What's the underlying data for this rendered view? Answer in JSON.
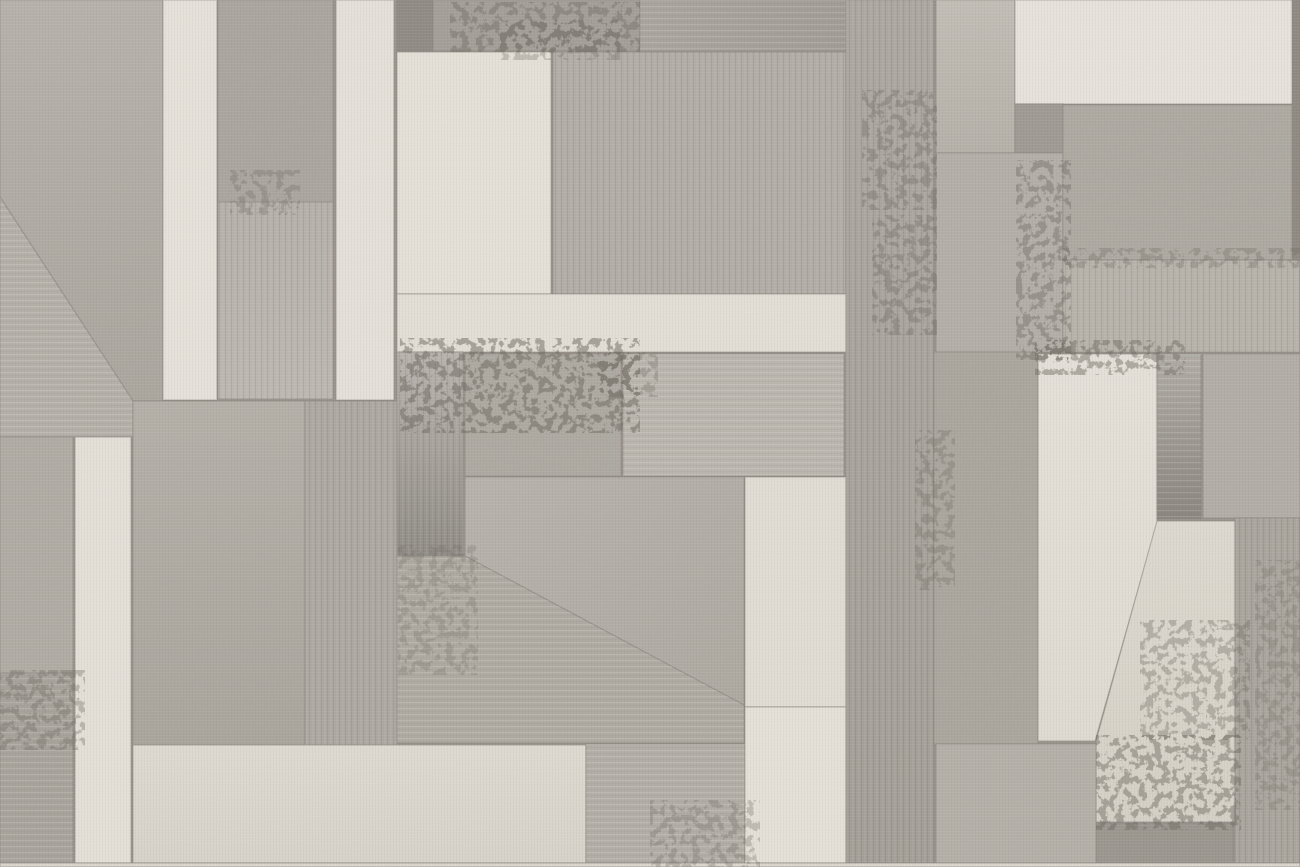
{
  "artwork": {
    "type": "abstract-geometric-patchwork-wallpaper",
    "description": "Abstract patchwork of rectangular and trapezoidal panels in warm grays and creams with concrete and linen grunge textures; thin dark seams between panels; two large diagonal cuts (upper left block and center block) and a slanted cream pentagon on the right.",
    "canvas": {
      "width": 1300,
      "height": 867
    },
    "seam_color": "#8b867f",
    "stain_color": "#6c675f",
    "palette": {
      "cream_light": "#e9e4dc",
      "cream": "#e7e2d9",
      "cream_dark": "#ddd8cf",
      "gray_light": "#c0bbb3",
      "gray_mid": "#b2ada6",
      "gray_deep": "#a9a49c",
      "gray_dark": "#8f8a83"
    },
    "tiles": [
      {
        "name": "big-gray-top-left",
        "poly": "0,0 163,0 163,401 133,401 0,197",
        "grad": {
          "from": "#b7b2ab",
          "to": "#aba69e",
          "dir": "v"
        }
      },
      {
        "name": "diagonal-lower-piece",
        "poly": "0,197 133,401 133,437 0,437",
        "fill": "#b6b1a9",
        "overlay": "h"
      },
      {
        "name": "left-mid-block",
        "rect": [
          0,
          437,
          73,
          236
        ],
        "fill": "#b1aca4"
      },
      {
        "name": "left-lower-block",
        "rect": [
          0,
          673,
          73,
          190
        ],
        "fill": "#a9a49c",
        "overlay": "h"
      },
      {
        "name": "left-cream-strip",
        "rect": [
          75,
          437,
          56,
          426
        ],
        "fill": "#e6e1d9"
      },
      {
        "name": "cream-strip-1",
        "rect": [
          163,
          0,
          54,
          400
        ],
        "fill": "#e8e3db"
      },
      {
        "name": "column2-upper",
        "rect": [
          218,
          0,
          115,
          202
        ],
        "fill": "#aba69f"
      },
      {
        "name": "column2-lower",
        "rect": [
          218,
          202,
          115,
          197
        ],
        "grad": {
          "from": "#b4afa8",
          "to": "#bcb7b0",
          "dir": "v"
        },
        "overlay": "v"
      },
      {
        "name": "cream-strip-2",
        "rect": [
          336,
          0,
          58,
          400
        ],
        "fill": "#e7e2da"
      },
      {
        "name": "dark-grunge-square",
        "rect": [
          397,
          0,
          36,
          53
        ],
        "fill": "#908b84"
      },
      {
        "name": "top-band-left",
        "rect": [
          433,
          0,
          207,
          51
        ],
        "fill": "#a49f98"
      },
      {
        "name": "top-band-right",
        "rect": [
          640,
          0,
          208,
          51
        ],
        "grad": {
          "from": "#aba69f",
          "to": "#a29d96",
          "dir": "h"
        },
        "overlay": "h"
      },
      {
        "name": "cream-block-upper-mid",
        "rect": [
          397,
          52,
          154,
          242
        ],
        "fill": "#e7e2d9"
      },
      {
        "name": "gray-block-upper-mid",
        "rect": [
          553,
          52,
          293,
          242
        ],
        "fill": "#b1aca5",
        "overlay": "v"
      },
      {
        "name": "cream-bar",
        "rect": [
          397,
          294,
          449,
          58
        ],
        "fill": "#e5e0d7"
      },
      {
        "name": "grunge-block-left",
        "rect": [
          133,
          401,
          172,
          344
        ],
        "grad": {
          "from": "#b5b0a8",
          "to": "#aaa59d",
          "dir": "v"
        }
      },
      {
        "name": "grunge-block-right",
        "rect": [
          305,
          401,
          92,
          344
        ],
        "fill": "#aca79f",
        "overlay": "v"
      },
      {
        "name": "metallic-gradient-left",
        "rect": [
          397,
          352,
          66,
          204
        ],
        "grad": {
          "from": "#b7b2ac",
          "to": "#8f8b85",
          "dir": "v"
        },
        "overlay": "v"
      },
      {
        "name": "block-a",
        "rect": [
          465,
          354,
          156,
          122
        ],
        "fill": "#aeaaa2"
      },
      {
        "name": "block-b",
        "rect": [
          623,
          354,
          221,
          122
        ],
        "fill": "#bcb7af",
        "overlay": "h"
      },
      {
        "name": "trapezoid-upper",
        "poly": "465,477 744,477 744,705 465,556",
        "grad": {
          "from": "#b8b3ac",
          "to": "#aea9a1",
          "dir": "d"
        }
      },
      {
        "name": "trapezoid-lower",
        "poly": "397,556 465,556 744,705 744,743 397,743",
        "fill": "#b0aba3",
        "overlay": "h"
      },
      {
        "name": "bottom-cream-bar",
        "rect": [
          133,
          745,
          453,
          118
        ],
        "grad": {
          "from": "#e0dbd2",
          "to": "#d9d4cb",
          "dir": "v"
        }
      },
      {
        "name": "bottom-mid-gray",
        "rect": [
          586,
          744,
          159,
          119
        ],
        "fill": "#b4afa7",
        "overlay": "h"
      },
      {
        "name": "right-mid-cream-upper",
        "rect": [
          745,
          477,
          101,
          230
        ],
        "fill": "#e3ded5"
      },
      {
        "name": "right-mid-cream-lower",
        "rect": [
          745,
          707,
          101,
          156
        ],
        "fill": "#e7e2d9"
      },
      {
        "name": "tall-dark-column",
        "rect": [
          846,
          0,
          88,
          863
        ],
        "grad": {
          "from": "#aba69f",
          "to": "#a29d95",
          "dir": "v"
        },
        "overlay": "v"
      },
      {
        "name": "right-light-block-top",
        "rect": [
          936,
          0,
          79,
          153
        ],
        "grad": {
          "from": "#c3beb6",
          "to": "#b6b1a9",
          "dir": "v"
        }
      },
      {
        "name": "top-right-cream",
        "rect": [
          1015,
          0,
          285,
          104
        ],
        "fill": "#e9e4dc"
      },
      {
        "name": "small-grunge-rect",
        "rect": [
          1015,
          104,
          48,
          49
        ],
        "fill": "#9f9a93"
      },
      {
        "name": "right-column-mid",
        "rect": [
          936,
          153,
          127,
          199
        ],
        "fill": "#b4afa8"
      },
      {
        "name": "big-block-top-right",
        "rect": [
          1063,
          105,
          237,
          155
        ],
        "fill": "#aeaaa2"
      },
      {
        "name": "streak-block-right",
        "rect": [
          1063,
          260,
          237,
          92
        ],
        "fill": "#b6b1a9",
        "overlay": "v"
      },
      {
        "name": "mid-right-column",
        "rect": [
          934,
          352,
          104,
          392
        ],
        "fill": "#aba69e"
      },
      {
        "name": "cream-pentagon",
        "poly": "1038,354 1157,354 1157,523 1095,741 1038,741",
        "grad": {
          "from": "#e7e2da",
          "to": "#e1dcd3",
          "dir": "v"
        }
      },
      {
        "name": "metallic-gradient-right",
        "rect": [
          1157,
          354,
          44,
          165
        ],
        "grad": {
          "from": "#b2aea7",
          "to": "#8a867f",
          "dir": "v"
        },
        "overlay": "h"
      },
      {
        "name": "right-block-mid",
        "rect": [
          1203,
          354,
          97,
          164
        ],
        "fill": "#b3aea7"
      },
      {
        "name": "light-trapezoid-right",
        "poly": "1157,521 1235,521 1235,822 1096,822 1096,741",
        "grad": {
          "from": "#dfdad1",
          "to": "#d7d2c8",
          "dir": "v"
        }
      },
      {
        "name": "right-column-bottom",
        "rect": [
          1235,
          518,
          65,
          345
        ],
        "fill": "#a8a39b",
        "overlay": "v"
      },
      {
        "name": "bottom-right-grunge",
        "rect": [
          1096,
          823,
          137,
          40
        ],
        "fill": "#9b968e"
      },
      {
        "name": "bottom-right-gray",
        "rect": [
          936,
          744,
          160,
          119
        ],
        "fill": "#b5b0a8"
      },
      {
        "name": "right-edge-sliver",
        "rect": [
          1292,
          0,
          8,
          260
        ],
        "fill": "#8e8981"
      },
      {
        "name": "bottom-edge-strip",
        "rect": [
          0,
          863,
          1300,
          4
        ],
        "fill": "#dcd7ce"
      }
    ],
    "stains": [
      {
        "rect": [
          400,
          338,
          240,
          95
        ],
        "opacity": 0.5
      },
      {
        "rect": [
          450,
          2,
          190,
          50
        ],
        "opacity": 0.4
      },
      {
        "rect": [
          500,
          20,
          120,
          40
        ],
        "opacity": 0.3
      },
      {
        "rect": [
          862,
          90,
          75,
          120
        ],
        "opacity": 0.35
      },
      {
        "rect": [
          872,
          215,
          65,
          120
        ],
        "opacity": 0.35
      },
      {
        "rect": [
          1016,
          160,
          55,
          200
        ],
        "opacity": 0.4
      },
      {
        "rect": [
          1035,
          340,
          150,
          35
        ],
        "opacity": 0.45
      },
      {
        "rect": [
          915,
          430,
          40,
          160
        ],
        "opacity": 0.3
      },
      {
        "rect": [
          1140,
          620,
          110,
          120
        ],
        "opacity": 0.35
      },
      {
        "rect": [
          1096,
          735,
          145,
          95
        ],
        "opacity": 0.45
      },
      {
        "rect": [
          0,
          670,
          85,
          80
        ],
        "opacity": 0.35
      },
      {
        "rect": [
          230,
          170,
          70,
          45
        ],
        "opacity": 0.3
      },
      {
        "rect": [
          650,
          800,
          110,
          70
        ],
        "opacity": 0.3
      },
      {
        "rect": [
          398,
          545,
          80,
          130
        ],
        "opacity": 0.25
      },
      {
        "rect": [
          598,
          352,
          60,
          45
        ],
        "opacity": 0.3
      },
      {
        "rect": [
          1063,
          248,
          240,
          20
        ],
        "opacity": 0.3
      },
      {
        "rect": [
          1255,
          560,
          45,
          250
        ],
        "opacity": 0.25
      }
    ]
  }
}
